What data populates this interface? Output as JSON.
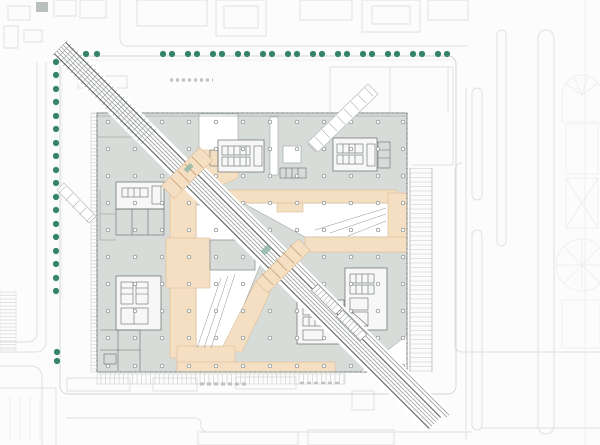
{
  "scene": {
    "name": "architectural-ground-floor-site-plan"
  },
  "colors": {
    "background": "#fcfcfc",
    "context_line": "#dfe1e0",
    "context_line_faint": "#ebecec",
    "site_line": "#cfd3d2",
    "plate_fill": "#d8dcd9",
    "plate_stroke": "#8d9391",
    "core_fill": "#f6f7f6",
    "core_stroke": "#676d6b",
    "beige_fill": "#f5dfc2",
    "beige_stroke": "#ddbd97",
    "bridge_rung": "#c89f73",
    "rail_dark": "#5d6361",
    "rail_mid": "#878d8b",
    "rail_hatch": "#a8aeac",
    "tree_fill": "#34836a",
    "column_stroke": "#7a807e",
    "accent_teal": "#8fb5a6",
    "tick_gray": "#c6cac8"
  },
  "trees": {
    "radius": 3.1,
    "top_row": {
      "y": 54,
      "xs": [
        86,
        97,
        163,
        172,
        188,
        197,
        213,
        222,
        238,
        247,
        263,
        272,
        288,
        297,
        313,
        322,
        338,
        347,
        363,
        372,
        388,
        397,
        413,
        422,
        438,
        447
      ]
    },
    "left_column": {
      "x": 56,
      "ys": [
        62,
        75,
        89,
        102,
        116,
        129,
        143,
        156,
        170,
        183,
        197,
        210,
        224,
        237,
        251,
        264,
        278,
        291
      ]
    },
    "extra": [
      [
        57,
        352
      ],
      [
        57,
        361
      ]
    ]
  },
  "columns": {
    "radius": 1.8,
    "xs": [
      108,
      135,
      162,
      189,
      216,
      243,
      270,
      297,
      324,
      351,
      378,
      403
    ],
    "ys": [
      122,
      149,
      176,
      203,
      230,
      257,
      284,
      311,
      338,
      366
    ]
  },
  "rail": {
    "start": [
      60,
      48
    ],
    "end": [
      435,
      423
    ],
    "offsets": [
      -8,
      -4.5,
      -1.5,
      1.5,
      4.5,
      8
    ],
    "branch_offsets": [
      12.5,
      15.5
    ]
  }
}
